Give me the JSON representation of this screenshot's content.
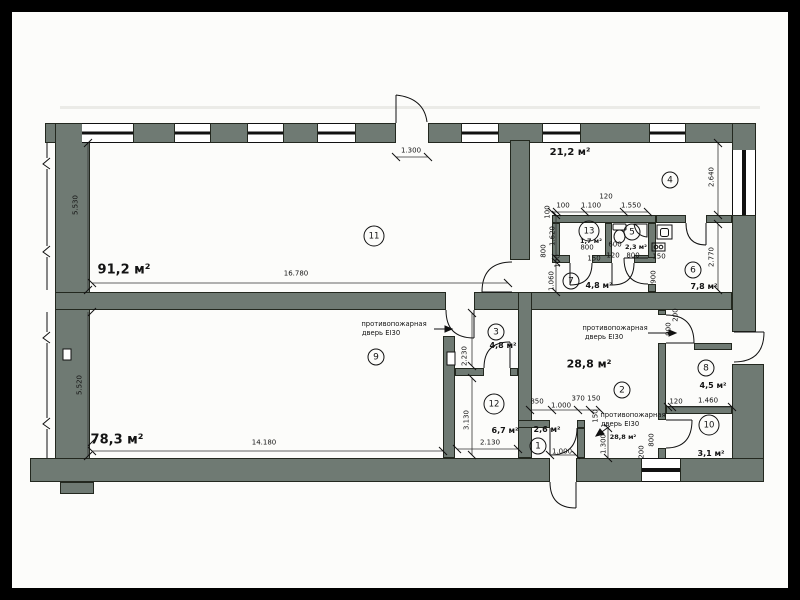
{
  "colors": {
    "wall_fill": "#6f7a73",
    "line": "#1a1a1a",
    "paper": "#fcfcfa"
  },
  "rooms": {
    "r1": {
      "num": "1",
      "area": "2,6 м²"
    },
    "r2": {
      "num": "2",
      "area": "28,8 м²",
      "area2": "28,8 м²"
    },
    "r3": {
      "num": "3",
      "area": "4,8 м²"
    },
    "r4": {
      "num": "4",
      "area": "21,2 м²"
    },
    "r5": {
      "num": "5",
      "area": "2,3 м²"
    },
    "r6": {
      "num": "6",
      "area": "7,8 м²"
    },
    "r7": {
      "num": "7",
      "area": "4,8 м²"
    },
    "r8": {
      "num": "8",
      "area": "4,5 м²"
    },
    "r9": {
      "num": "9",
      "area": "78,3 м²"
    },
    "r10": {
      "num": "10",
      "area": "3,1 м²"
    },
    "r11": {
      "num": "11",
      "area": "91,2 м²"
    },
    "r12": {
      "num": "12",
      "area": "6,7 м²"
    },
    "r13": {
      "num": "13",
      "area": "1,7 м²"
    }
  },
  "dims": {
    "d_5530": "5.530",
    "d_16780": "16.780",
    "d_1300_top": "1.300",
    "d_5520": "5.520",
    "d_14180": "14.180",
    "d_2640": "2.640",
    "d_2770": "2.770",
    "d_2230": "2.230",
    "d_3130": "3.130",
    "d_2130": "2.130",
    "d_1620": "1.620",
    "d_1060": "1.060",
    "d_100_a": "100",
    "d_1100": "1.100",
    "d_120_top": "120",
    "d_1550": "1.550",
    "d_100_b": "100",
    "d_100_c": "100",
    "d_800_corr": "800",
    "d_800_13": "800",
    "d_150_13": "150",
    "d_600": "600",
    "d_120_5": "120",
    "d_800_5": "800",
    "d_150_5": "150",
    "d_900_6": "900",
    "d_900_2": "900",
    "d_200_2": "200",
    "d_850": "850",
    "d_1000_a": "1.000",
    "d_370150": "370 150",
    "d_150_1": "150",
    "d_1000_b": "1.000",
    "d_1300_1": "1.300",
    "d_200_10": "200",
    "d_800_10": "800",
    "d_120_10": "120",
    "d_1460": "1.460"
  },
  "labels": {
    "fire_line1": "противопожарная",
    "fire_line2": "дверь EI30"
  },
  "icons": {
    "toilet": "toilet-icon",
    "corner_sink": "corner-sink-icon",
    "vent_shaft": "vent-shaft-icon",
    "stove": "stove-burners-icon",
    "panel": "electrical-panel-icon"
  }
}
